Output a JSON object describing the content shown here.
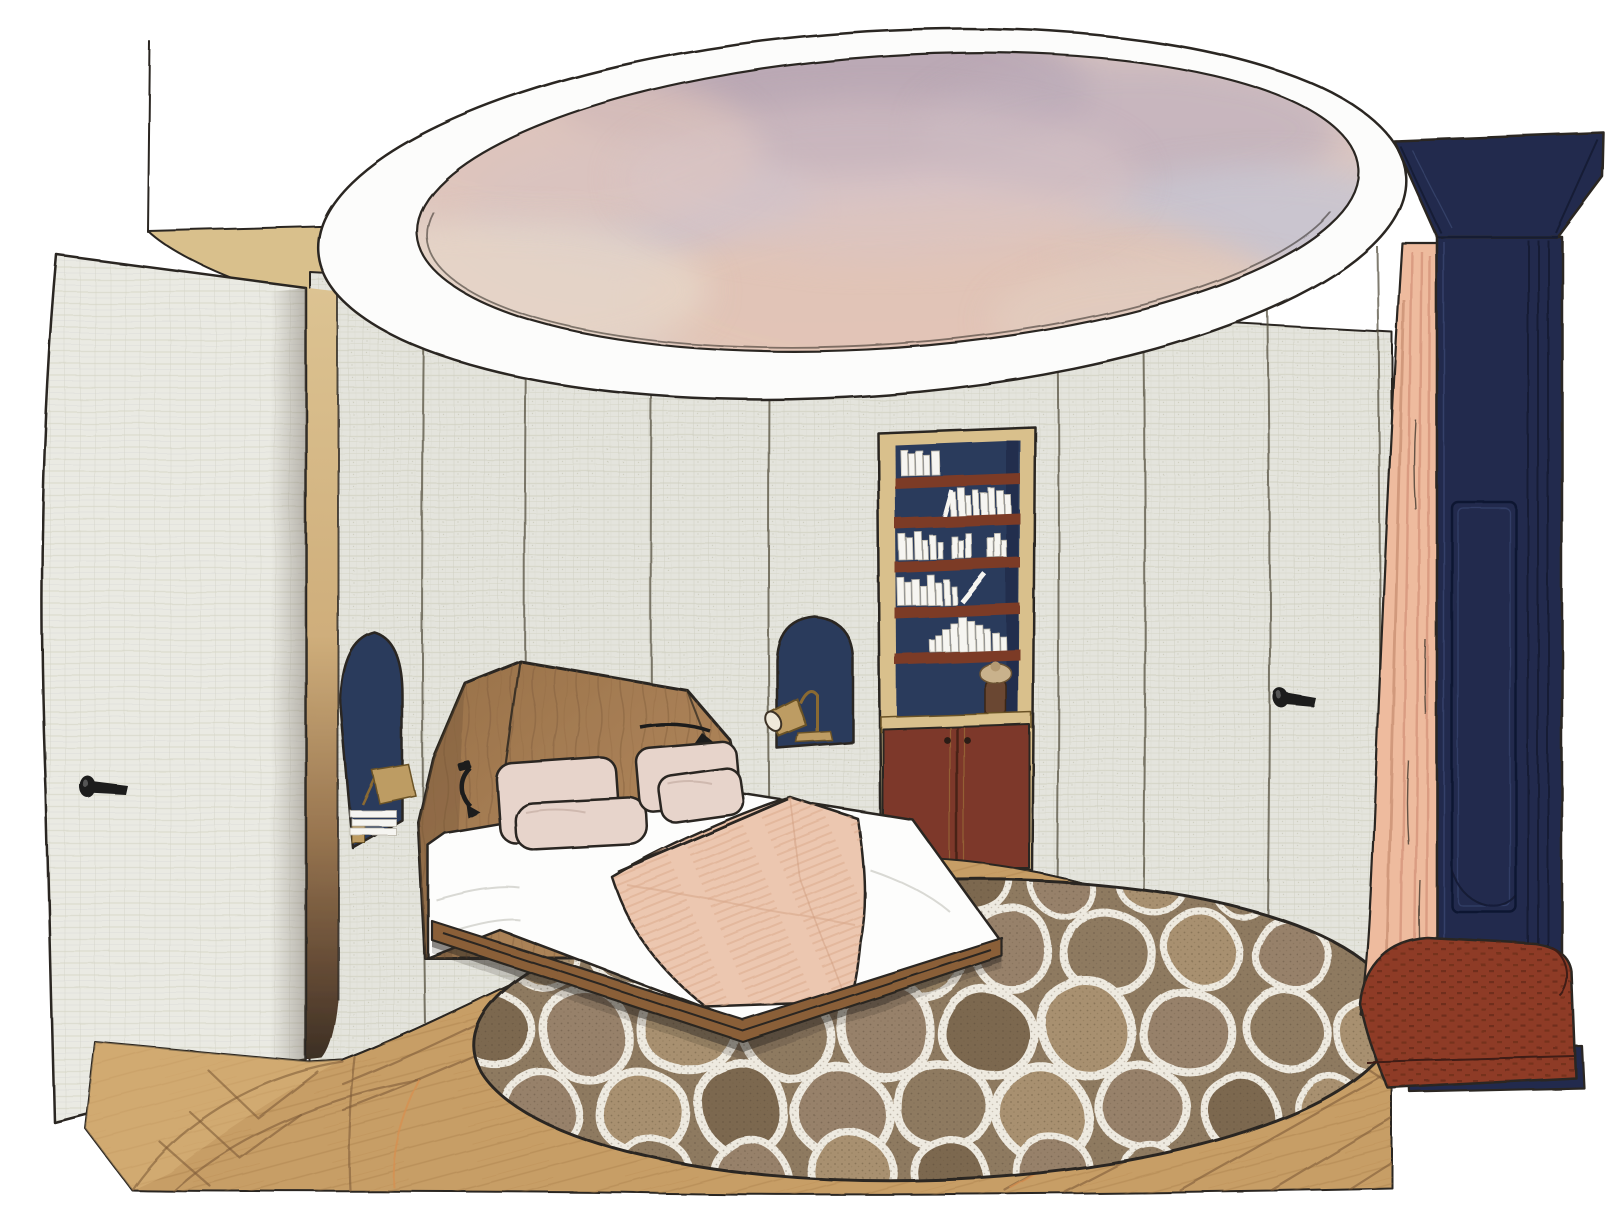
{
  "scene": {
    "room": "Hand-drawn interior rendering of an oval bedroom with a painted sky ceiling",
    "elements": [
      "oval ceiling cove",
      "sky mural",
      "curved fabric-panelled walls",
      "open upholstered door with black lever handle",
      "wood door jamb",
      "arched navy niche with brass task lamp and books (left)",
      "arched navy niche with brass task lamp (right)",
      "recessed bookshelf with white books, figurine and mahogany cabinet",
      "faceted wood headboard with black reading lights",
      "bed with white sheets, blush pillows and peach blanket on wood platform",
      "round crackle-pattern area rug",
      "oak plank floor",
      "concealed wall door with black lever handle (right)",
      "navy panelled column with cornice",
      "peach curtain",
      "rust upholstered bench"
    ]
  },
  "palette": {
    "paper": "#ffffff",
    "outline": "#2b2620",
    "wall": "#e4e4dd",
    "wallSeam": "#55503f",
    "door": "#eaeae3",
    "coveWhite": "#fcfcfb",
    "skyBase": "#d9c4c1",
    "oakLight": "#d9c08c",
    "oakDark": "#3c2f24",
    "headboard": "#a87f55",
    "headboardDark": "#8f6a44",
    "bedBase": "#8a5f38",
    "sheet": "#fdfdfc",
    "pillow": "#e7d4cb",
    "blanket": "#ecc7b0",
    "blanketShade": "#dcab8e",
    "navy": "#2c3a5c",
    "navyDeep": "#222c4e",
    "shelf": "#7c3b27",
    "cabinet": "#7d392a",
    "brass": "#bd9c63",
    "curtain": "#eebb9e",
    "curtainShade": "#d6977c",
    "bench": "#8e3b26",
    "benchDark": "#582415",
    "rugBase": "#8e7a61",
    "rugCellA": "#97816a",
    "rugCellB": "#a8906f",
    "rugCellC": "#7c684f",
    "rugLine": "#eeeae0",
    "floor": "#c79e66",
    "floorLine": "#7e5c38",
    "floorWarm": "#d88f4e"
  }
}
